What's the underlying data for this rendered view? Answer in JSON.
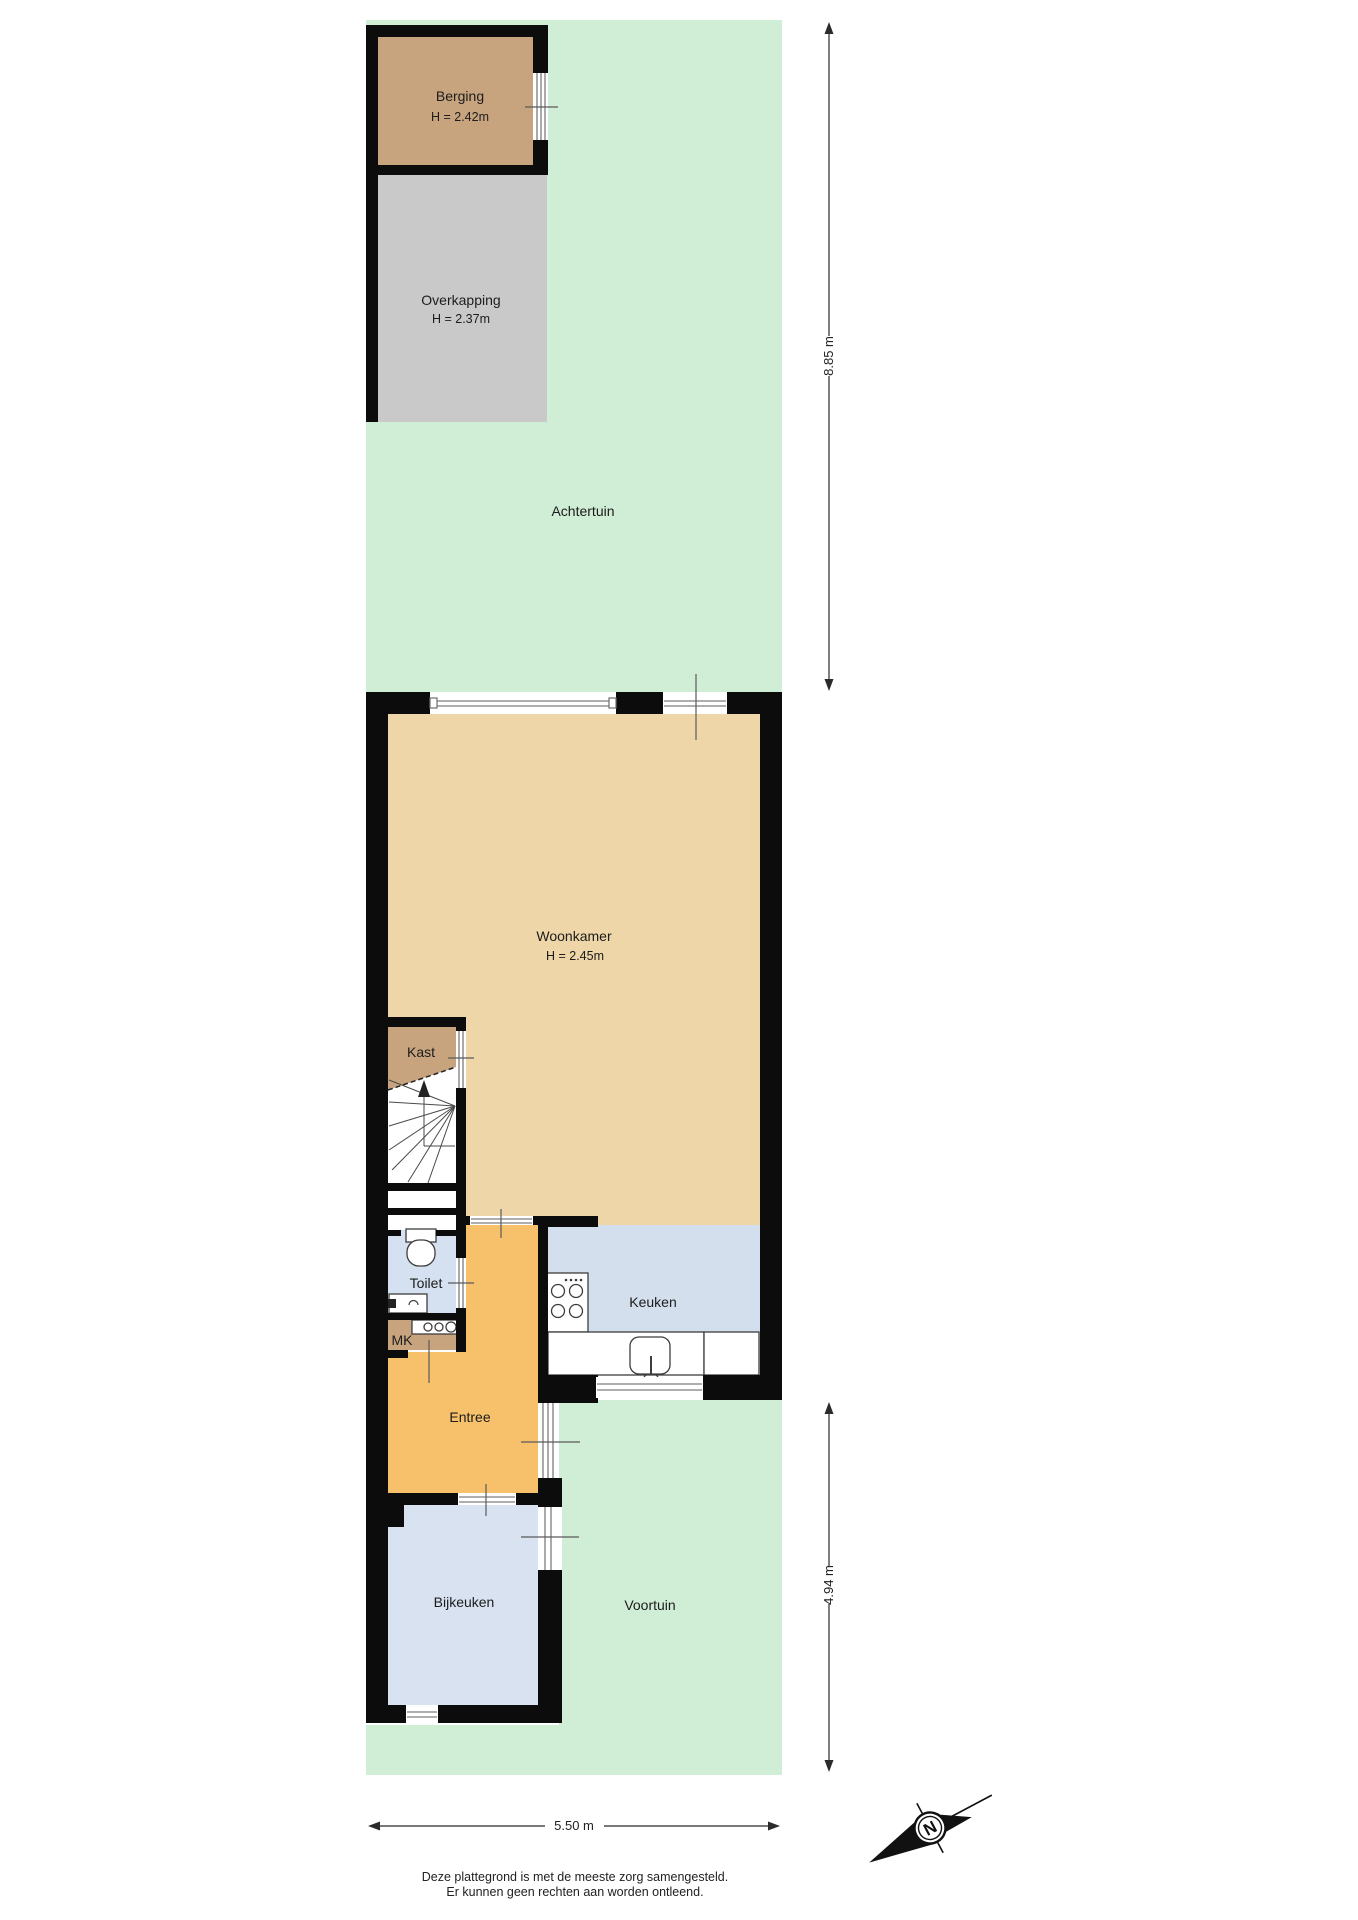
{
  "rooms": {
    "berging": {
      "name": "Berging",
      "height": "H = 2.42m"
    },
    "overkapping": {
      "name": "Overkapping",
      "height": "H = 2.37m"
    },
    "achtertuin": {
      "name": "Achtertuin"
    },
    "woonkamer": {
      "name": "Woonkamer",
      "height": "H = 2.45m"
    },
    "kast": {
      "name": "Kast"
    },
    "toilet": {
      "name": "Toilet"
    },
    "meterkast": {
      "name": "MK"
    },
    "entree": {
      "name": "Entree"
    },
    "keuken": {
      "name": "Keuken"
    },
    "bijkeuken": {
      "name": "Bijkeuken"
    },
    "voortuin": {
      "name": "Voortuin"
    }
  },
  "dimensions": {
    "garden_depth": "8.85 m",
    "front_depth": "4.94 m",
    "width": "5.50 m"
  },
  "compass": {
    "north": "N"
  },
  "footer": {
    "line1": "Deze plattegrond is met de meeste zorg samengesteld.",
    "line2": "Er kunnen geen rechten aan worden ontleend."
  },
  "colors": {
    "garden": "#d0edd6",
    "woonkamer": "#eed6a8",
    "entree": "#f7c16c",
    "berging": "#c7a47e",
    "kast": "#c7a47e",
    "meterkast": "#c7a47e",
    "overkapping": "#c9c9c9",
    "keuken": "#d3dfec",
    "toilet": "#d5e1f0",
    "bijkeuken": "#d8e2f0"
  }
}
